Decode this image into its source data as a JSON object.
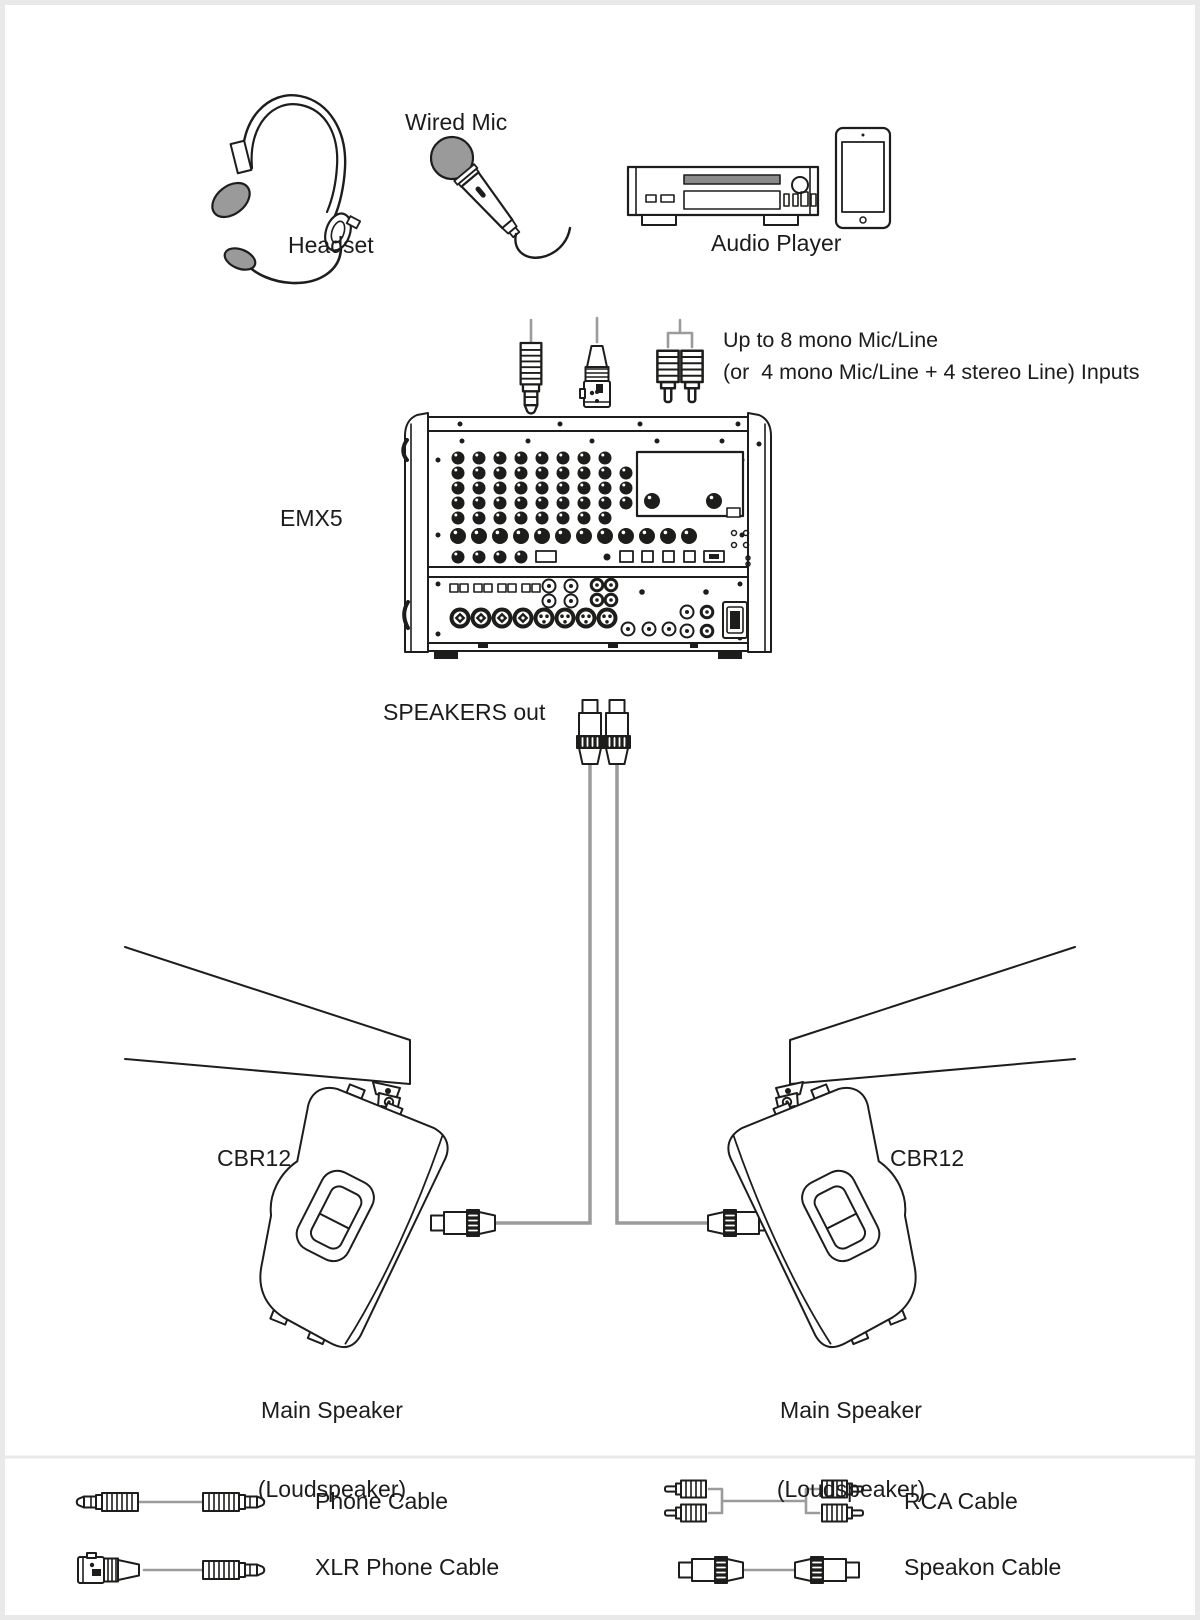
{
  "diagram": {
    "sources": {
      "headset": "Headset",
      "wired_mic": "Wired Mic",
      "audio_player": "Audio Player"
    },
    "inputs_note_line1": "Up to 8 mono Mic/Line",
    "inputs_note_line2": "(or  4 mono Mic/Line + 4 stereo Line) Inputs",
    "mixer_model": "EMX5",
    "speakers_out_label": "SPEAKERS out",
    "left_speaker": {
      "model": "CBR12",
      "role_line1": "Main Speaker",
      "role_line2": "(Loudspeaker)"
    },
    "right_speaker": {
      "model": "CBR12",
      "role_line1": "Main Speaker",
      "role_line2": "(Loudspeaker)"
    },
    "icons": {
      "headset": "headset-icon",
      "wired_mic": "microphone-icon",
      "audio_player": "cd-player-icon",
      "tablet": "tablet-icon",
      "phone_plug": "phone-plug-icon",
      "xlr_plug": "xlr-plug-icon",
      "rca_plug": "rca-plug-icon",
      "mixer": "mixer-illustration",
      "speakon": "speakon-connector-icon",
      "speaker": "loudspeaker-illustration"
    },
    "colors": {
      "line": "#1d1d1b",
      "gray_fill": "#9a9a9a",
      "cable_gray": "#9b9b9b",
      "slot_gray": "#8a8a8a",
      "border_gray": "#e9e9e9"
    }
  },
  "legend": {
    "items": [
      {
        "label": "Phone Cable"
      },
      {
        "label": "XLR Phone Cable"
      },
      {
        "label": "RCA Cable"
      },
      {
        "label": "Speakon Cable"
      }
    ]
  }
}
